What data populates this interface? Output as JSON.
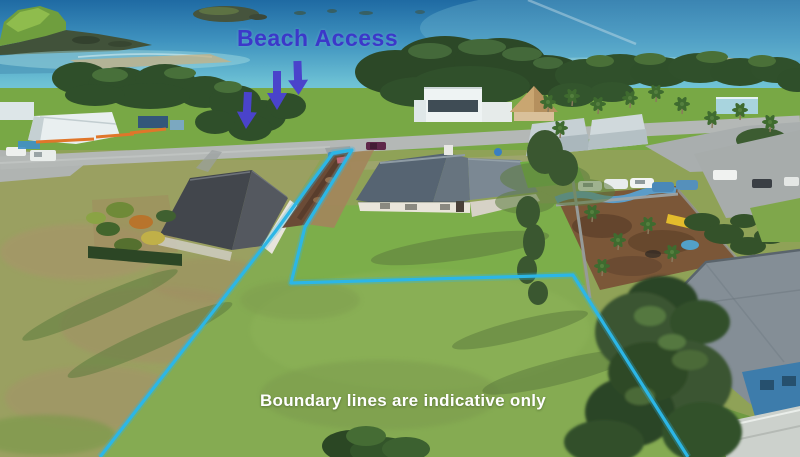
{
  "image": {
    "kind": "aerial-drone-real-estate-photo",
    "width": 800,
    "height": 457
  },
  "annotations": {
    "beach_access": {
      "label": "Beach Access",
      "label_color": "#3c38c9",
      "arrow_color": "#4a43cb",
      "arrow_count": "3"
    },
    "boundary": {
      "note": "Boundary lines are indicative only",
      "note_color": "#ffffff",
      "line_color": "#2cb6e6",
      "points": "100,457 275,232 333,153 352,150 305,227 291,283 573,275 688,457"
    }
  },
  "scene": {
    "sea_deep": "#1f6aa3",
    "sea_shallow": "#8fd5dd",
    "sand": "#c7b284",
    "shore_tree": "#2f4f2a",
    "reserve_lawn": "#76a843",
    "field_grass": "#8fa257",
    "road": "#b4b8b6",
    "driveway_dirt": "#6b4b36",
    "center_house_roof": "#67747f",
    "left_house_roof": "#45494f",
    "right_house_roof": "#848e96",
    "playground_bark": "#7b5738"
  }
}
